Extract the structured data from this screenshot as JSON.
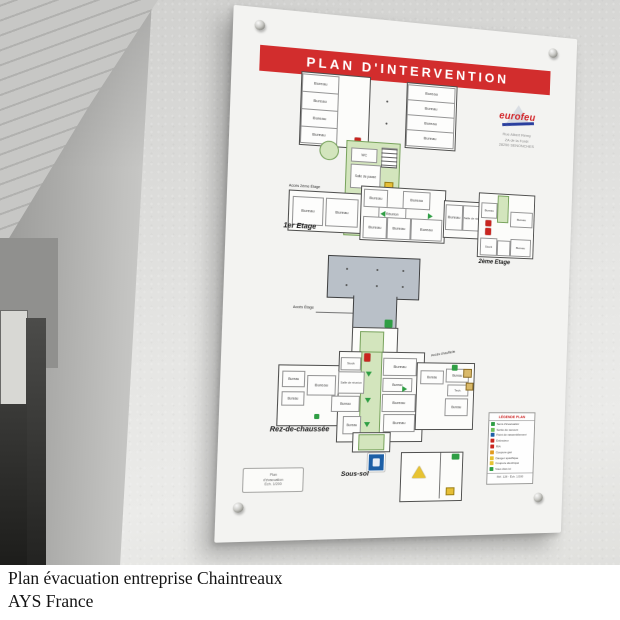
{
  "colors": {
    "accent_red": "#d22d2d",
    "evac_green": "#d3e5bd",
    "safety_green": "#2f9e44",
    "alarm_red": "#c9251f",
    "info_blue": "#1d5fa6",
    "warn_yellow": "#e7c332"
  },
  "caption": {
    "line1": "Plan évacuation entreprise Chaintreaux",
    "line2": "AYS France"
  },
  "board": {
    "title": "PLAN D'INTERVENTION",
    "logo": {
      "name": "eurofeu",
      "address": [
        "Rue Albert Rémy",
        "ZA de la Forêt",
        "28250 SENONCHES"
      ]
    },
    "floors": {
      "first": "1er Etage",
      "second": "2ème Etage",
      "ground": "Rez-de-chaussée",
      "basement": "Sous-sol"
    },
    "rooms": {
      "bureau": "Bureau",
      "reunion": "Réunion",
      "salle_reunion": "Salle de réunion",
      "salle_pause": "Salle de pause",
      "wc": "WC",
      "stock": "Stock",
      "tech": "Tech."
    },
    "annotations": {
      "acces_2eme": "Accès 2ème Étage",
      "acces_etage": "Accès Étage",
      "acces_chaufferie": "Accès chaufferie"
    },
    "legend": {
      "title": "LÉGENDE PLAN",
      "items": [
        {
          "color": "#2f9e44",
          "label": "Sens d'évacuation"
        },
        {
          "color": "#6fbf5a",
          "label": "Sortie de secours"
        },
        {
          "color": "#1d5fa6",
          "label": "Point de rassemblement"
        },
        {
          "color": "#c9251f",
          "label": "Extincteur"
        },
        {
          "color": "#c9251f",
          "label": "RIA"
        },
        {
          "color": "#e09a20",
          "label": "Coupure gaz"
        },
        {
          "color": "#e7c332",
          "label": "Danger spécifique"
        },
        {
          "color": "#e7c332",
          "label": "Coupure électrique"
        },
        {
          "color": "#2f9e44",
          "label": "Vous êtes ici"
        }
      ],
      "footer": "Réf. 128 - Éch. 1/200"
    },
    "cartouche": {
      "l1": "Plan",
      "l2": "d'évacuation",
      "l3": "Éch. 1/200"
    }
  }
}
